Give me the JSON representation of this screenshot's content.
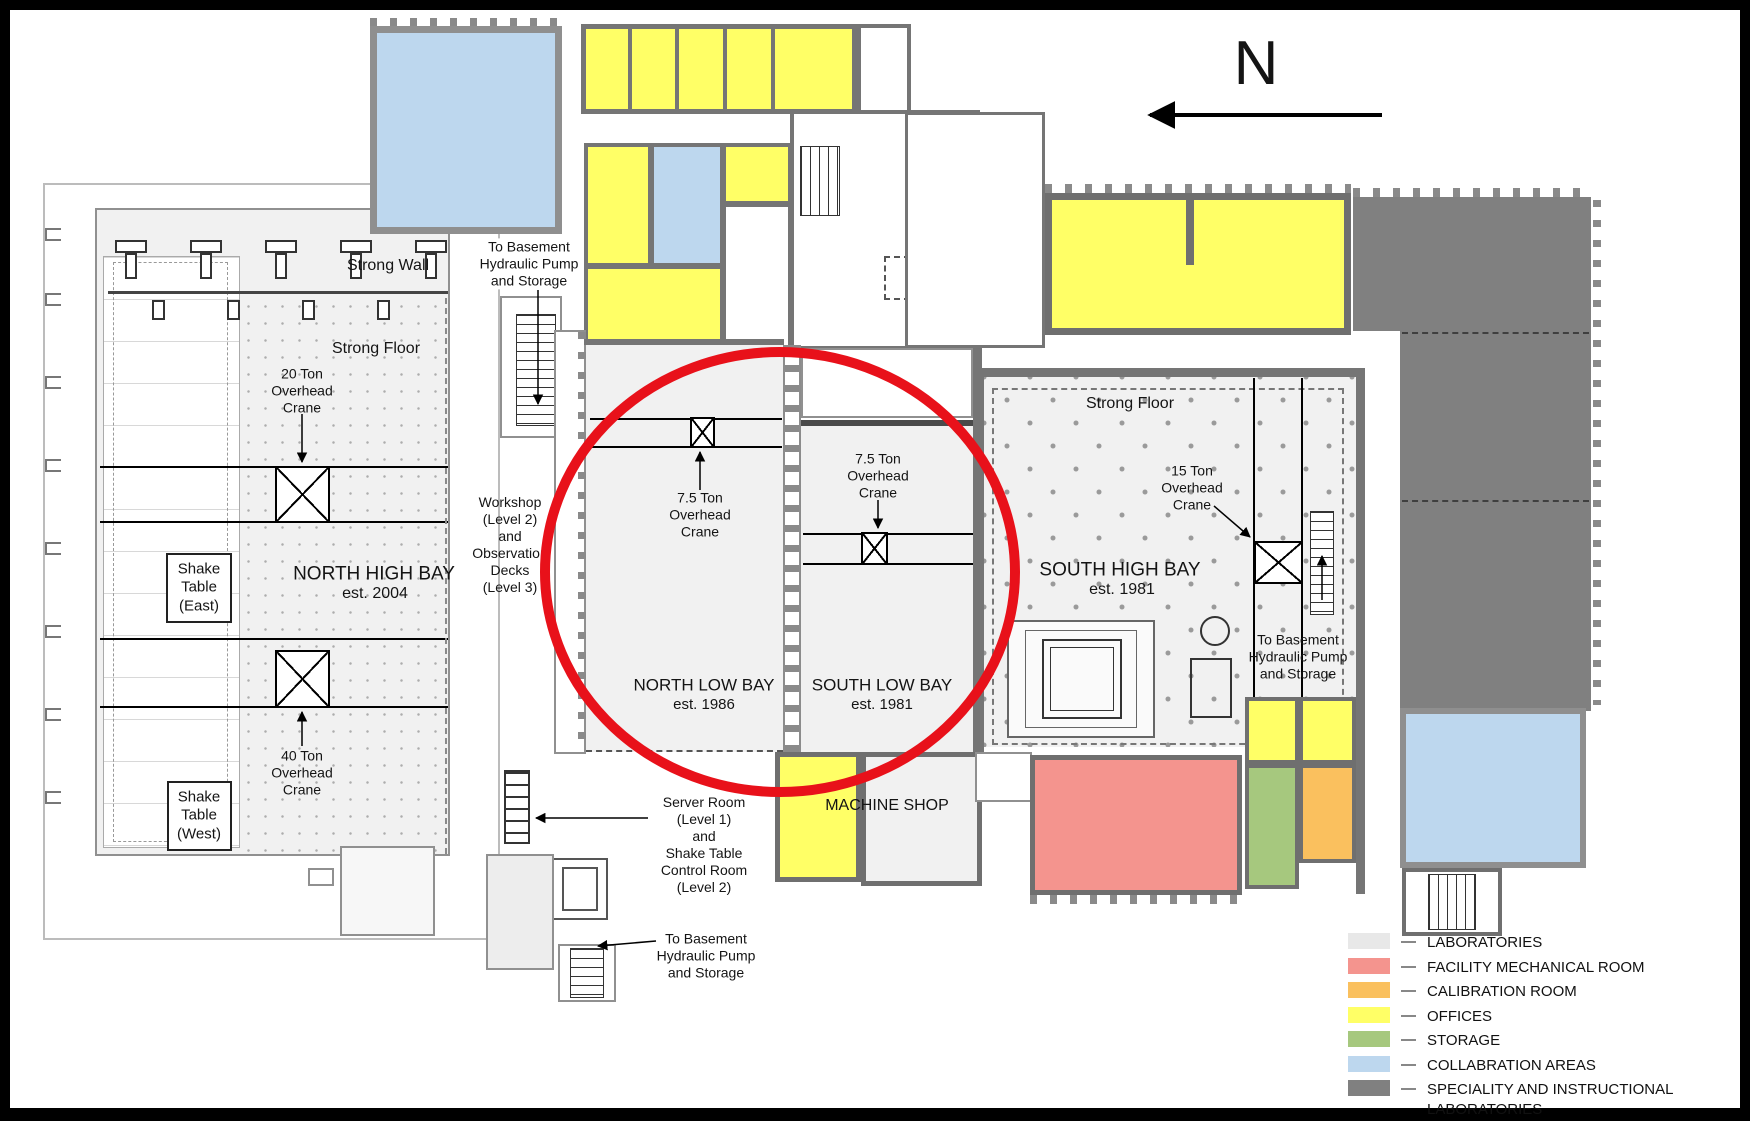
{
  "compass": {
    "label": "N"
  },
  "highlight": {
    "color": "#e8111a"
  },
  "palette": {
    "laboratories": "#f1f1f1",
    "facility_mechanical": "#f4948e",
    "calibration": "#fac05e",
    "offices": "#ffff66",
    "storage": "#a6c87e",
    "collaboration": "#bdd7ee",
    "speciality": "#808080"
  },
  "bays": {
    "north_high_bay": {
      "name": "NORTH HIGH BAY",
      "est": "est. 2004"
    },
    "north_low_bay": {
      "name": "NORTH LOW BAY",
      "est": "est. 1986"
    },
    "south_low_bay": {
      "name": "SOUTH LOW BAY",
      "est": "est. 1981"
    },
    "south_high_bay": {
      "name": "SOUTH HIGH BAY",
      "est": "est. 1981"
    },
    "machine_shop": {
      "name": "MACHINE SHOP"
    }
  },
  "features": {
    "strong_wall": "Strong Wall",
    "strong_floor_north": "Strong Floor",
    "strong_floor_south": "Strong Floor",
    "shake_table_east": "Shake\nTable\n(East)",
    "shake_table_west": "Shake\nTable\n(West)",
    "crane_20_ton": "20 Ton\nOverhead\nCrane",
    "crane_40_ton": "40 Ton\nOverhead\nCrane",
    "crane_7_5_ton_north": "7.5 Ton\nOverhead\nCrane",
    "crane_7_5_ton_south": "7.5 Ton\nOverhead\nCrane",
    "crane_15_ton": "15 Ton\nOverhead\nCrane",
    "workshop_note": "Workshop\n(Level 2)\nand\nObservation\nDecks\n(Level 3)",
    "server_room_note": "Server Room\n(Level 1)\nand\nShake Table\nControl Room\n(Level 2)",
    "basement_note_top": "To Basement\nHydraulic Pump\nand Storage",
    "basement_note_bottom": "To Basement\nHydraulic Pump\nand Storage",
    "basement_note_right": "To Basement\nHydraulic Pump\nand Storage"
  },
  "legend": {
    "separator": "—",
    "items": [
      {
        "label": "LABORATORIES",
        "color": "#e8e8e8"
      },
      {
        "label": "FACILITY MECHANICAL ROOM",
        "color": "#f4948e"
      },
      {
        "label": "CALIBRATION ROOM",
        "color": "#fac05e"
      },
      {
        "label": "OFFICES",
        "color": "#ffff66"
      },
      {
        "label": "STORAGE",
        "color": "#a6c87e"
      },
      {
        "label": "COLLABRATION AREAS",
        "color": "#bdd7ee"
      },
      {
        "label": "SPECIALITY AND INSTRUCTIONAL\nLABORATORIES",
        "color": "#808080"
      }
    ]
  }
}
